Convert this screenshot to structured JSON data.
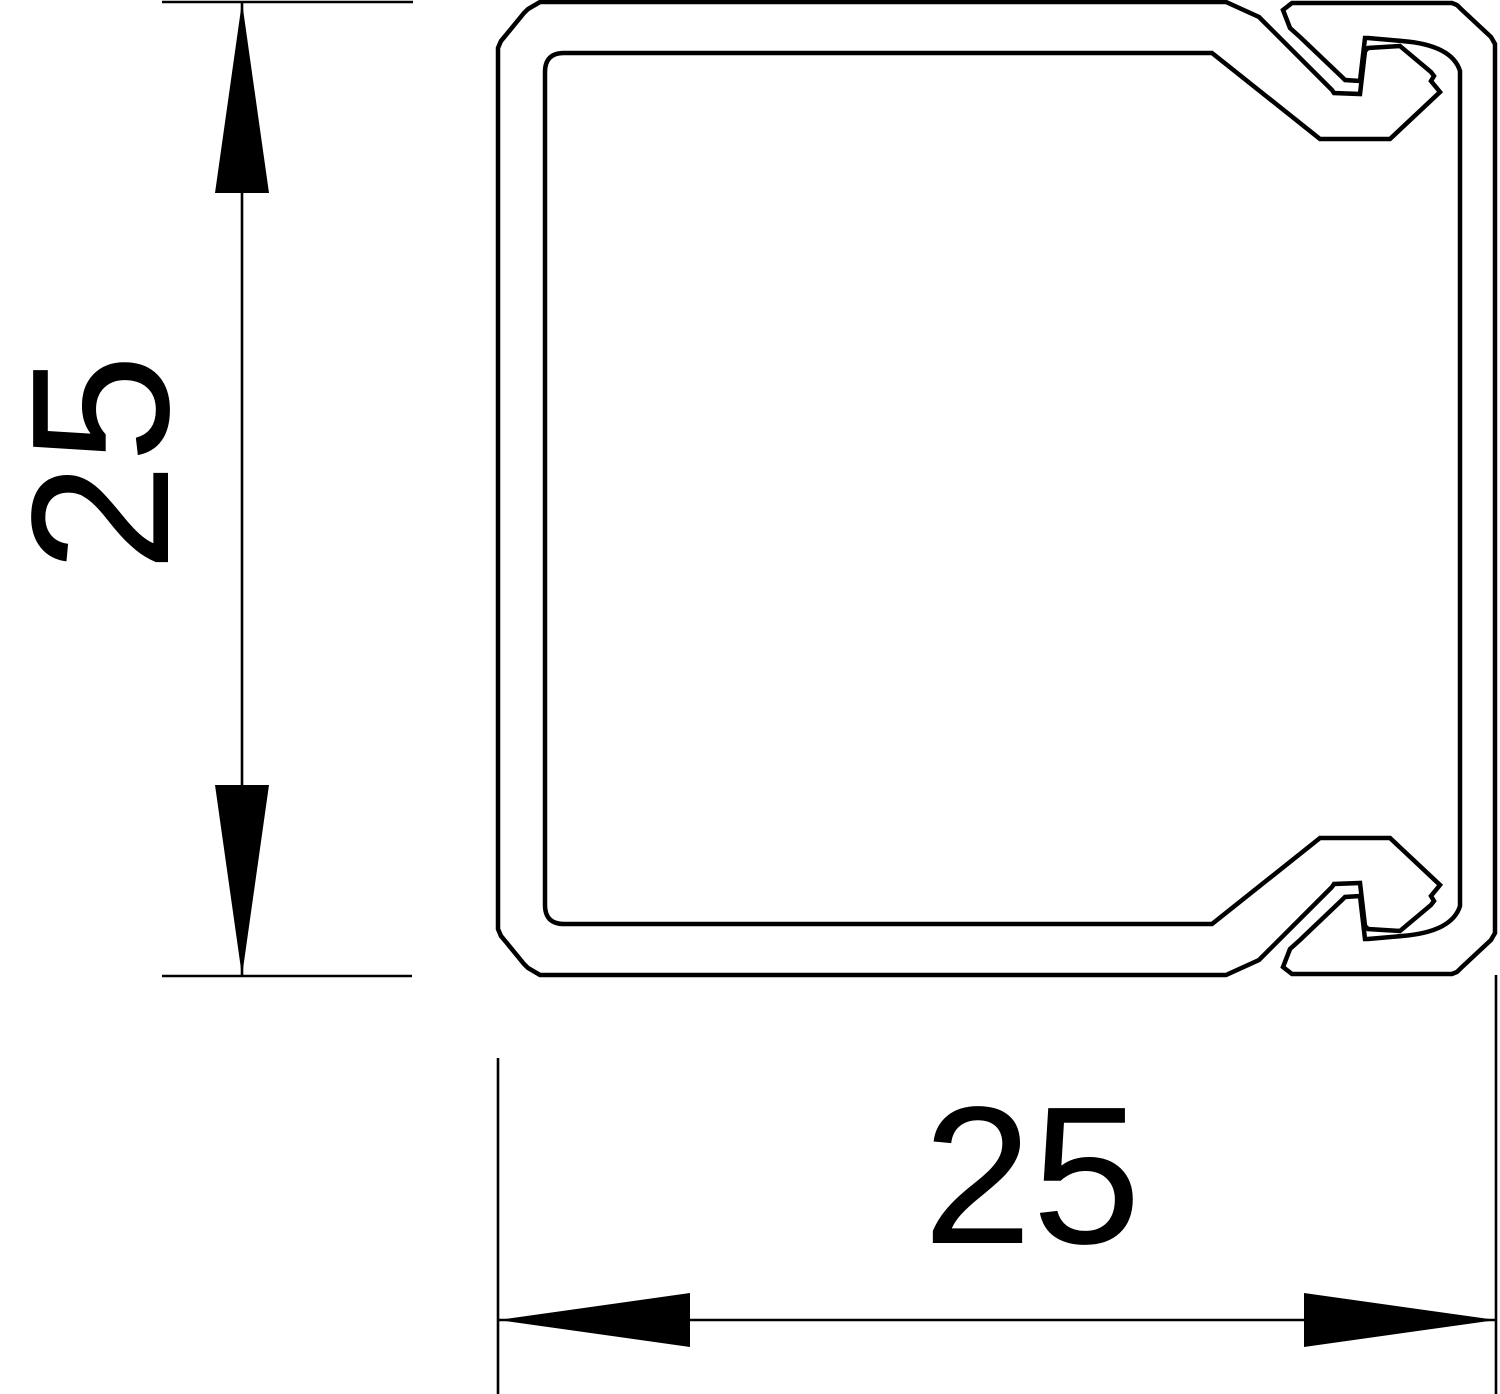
{
  "drawing": {
    "title": "trunking-profile-cross-section",
    "line_color": "#000000",
    "background_color": "#ffffff",
    "height_dimension": {
      "label": "25"
    },
    "width_dimension": {
      "label": "25"
    }
  }
}
